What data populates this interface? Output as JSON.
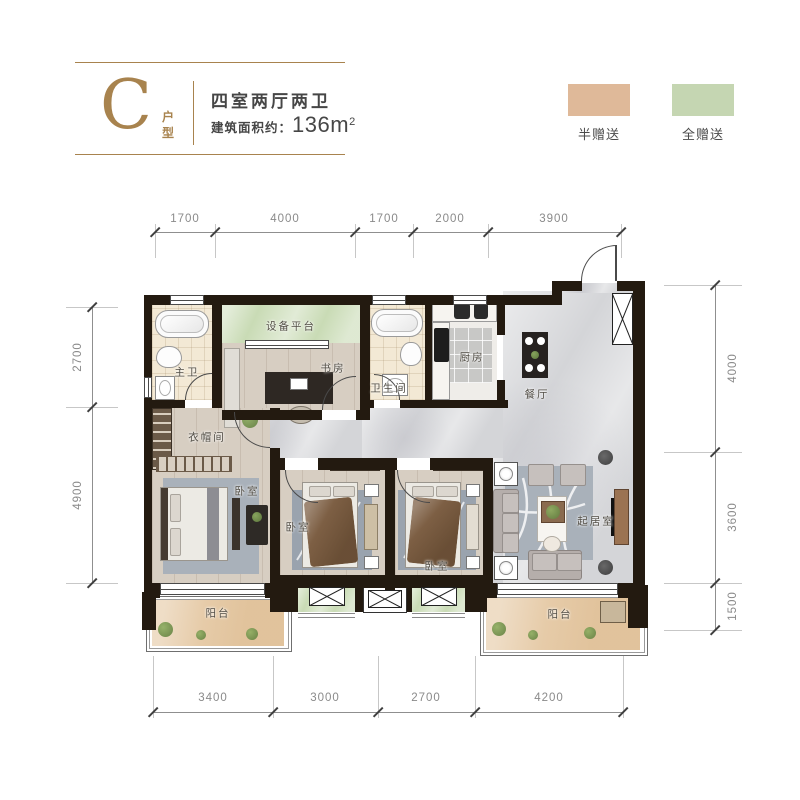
{
  "header": {
    "unit_letter": "C",
    "unit_suffix_top": "户",
    "unit_suffix_bottom": "型",
    "title": "四室两厅两卫",
    "area_label": "建筑面积约：",
    "area_value": "136m",
    "area_exponent": "2"
  },
  "legend": {
    "items": [
      {
        "label": "半赠送",
        "color": "#dfb999"
      },
      {
        "label": "全赠送",
        "color": "#c5d6b2"
      }
    ]
  },
  "rooms": {
    "master_bath": "主卫",
    "equipment_platform": "设备平台",
    "study": "书房",
    "bathroom": "卫生间",
    "kitchen": "厨房",
    "dining": "餐厅",
    "cloakroom": "衣帽间",
    "master_bedroom": "卧室",
    "bedroom2": "卧室",
    "bedroom3": "卧室",
    "living": "起居室",
    "balcony_left": "阳台",
    "balcony_right": "阳台"
  },
  "dimensions": {
    "top": [
      "1700",
      "4000",
      "1700",
      "2000",
      "3900"
    ],
    "bottom": [
      "3400",
      "3000",
      "2700",
      "4200"
    ],
    "left": [
      "2700",
      "4900"
    ],
    "right": [
      "4000",
      "3600",
      "1500"
    ]
  },
  "colors": {
    "gold": "#a8834e",
    "half_gift": "#dfb999",
    "full_gift": "#c5d6b2",
    "wall": "#231a10",
    "marble_floor": "#d4d5d8",
    "wood_floor": "#d7cec2",
    "balcony_floor": "#e6cba8",
    "green_area": "#c9dbb5"
  }
}
